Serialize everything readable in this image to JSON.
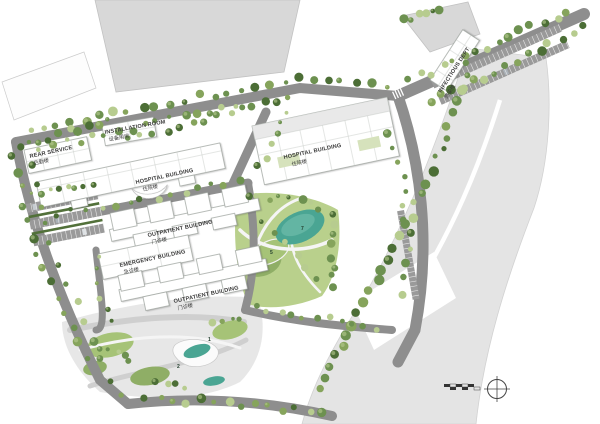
{
  "buildings": {
    "rear_service": {
      "en": "REAR SERVICE",
      "zh": "后勤楼"
    },
    "installation_room": {
      "en": "INSTALLATION ROOM",
      "zh": "设备用房"
    },
    "hospital_left": {
      "en": "HOSPITAL BUILDING",
      "zh": "住院楼"
    },
    "hospital_right": {
      "en": "HOSPITAL BUILDING",
      "zh": "住院楼"
    },
    "outpatient_mid": {
      "en": "OUTPATIENT BUILDING",
      "zh": "门诊楼"
    },
    "emergency": {
      "en": "EMERGENCY BUILDING",
      "zh": "急诊楼"
    },
    "outpatient_low": {
      "en": "OUTPATIENT BUILDING",
      "zh": "门诊楼"
    },
    "infectious": {
      "en": "INFECTIOUS DEPT",
      "zh": "感染楼"
    }
  },
  "markers": {
    "pond": "7",
    "lawn": "5",
    "plaza_a": "2",
    "plaza_b": "1"
  },
  "icons": {
    "compass": "north-compass",
    "scale_bar": "scale-bar"
  },
  "colors": {
    "offsite": "#d8d8d8",
    "offsite_edge": "#c2c2c2",
    "band": "#e4e4e4",
    "road": "#8e8e8e",
    "building": "#ffffff",
    "outline": "#9aa09b",
    "lawn": "#b9d08c",
    "lawn_dark": "#8fae66",
    "lawn_mid": "#a6c377",
    "pond": "#4aa593",
    "pond_light": "#63b5a3",
    "tree_dark": "#4c6e36",
    "tree_mid": "#6d9150",
    "tree_light": "#86a45c",
    "tree_pale": "#b7cc8f",
    "plaza": "#e7e7e7",
    "label": "#3b3b3b"
  }
}
